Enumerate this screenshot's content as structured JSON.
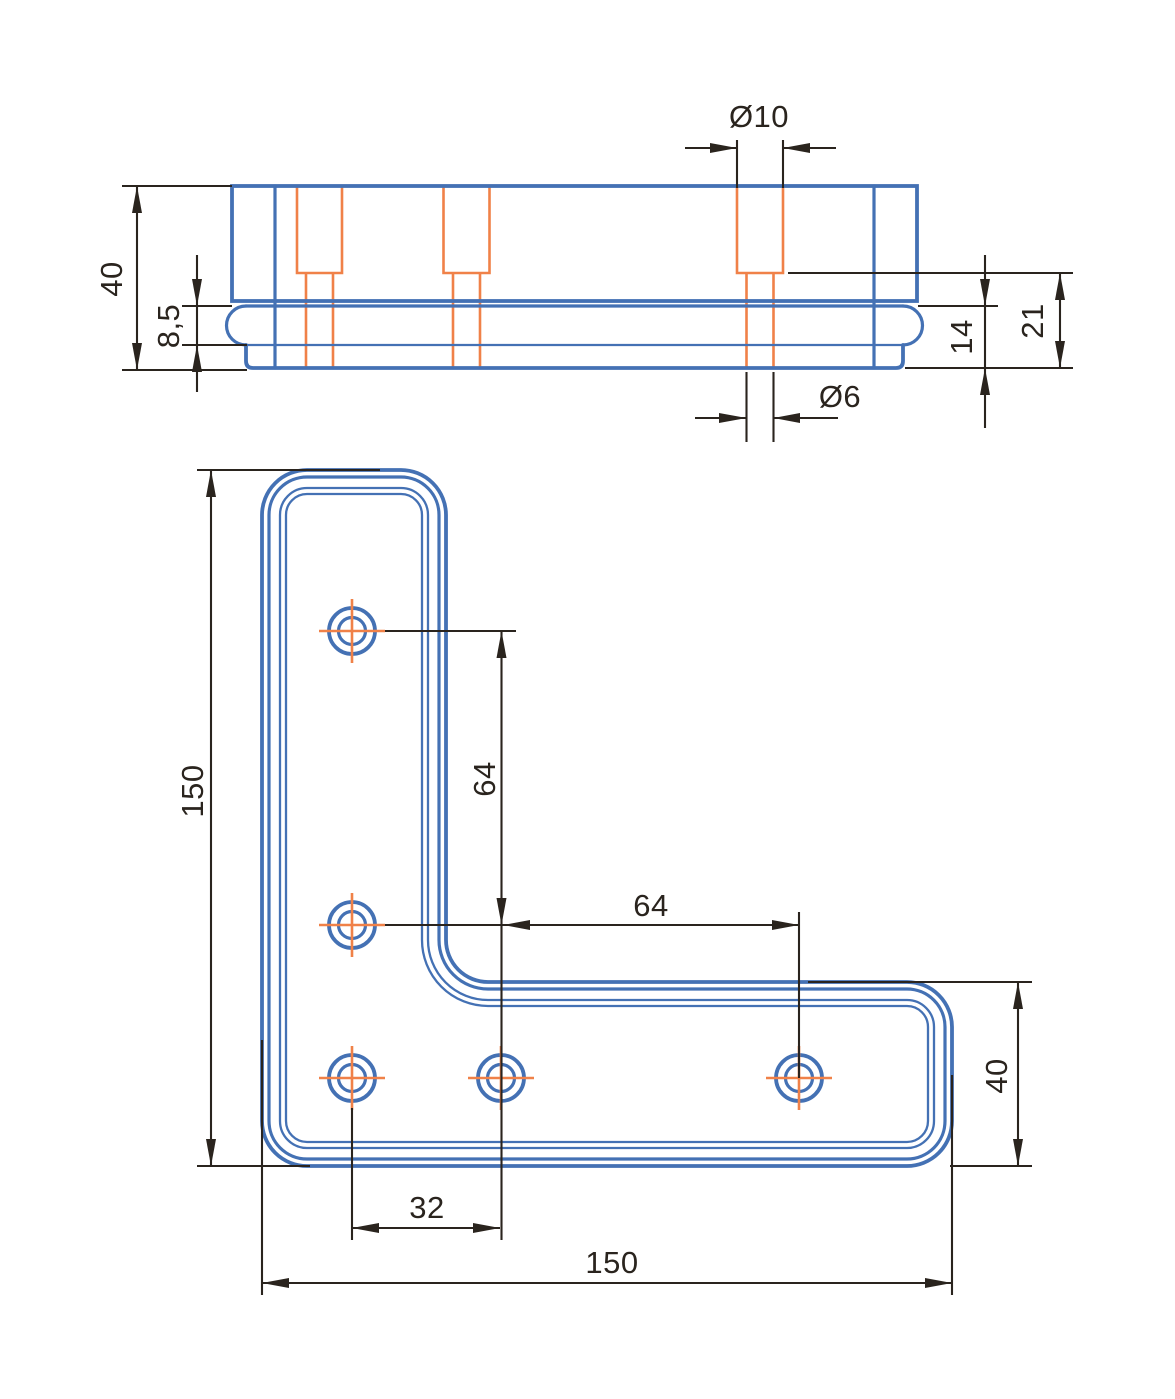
{
  "title": "Two-view technical drawing of an L-shaped corner bracket with counterbored holes",
  "colors": {
    "outline_blue": "#4471b4",
    "hidden_orange": "#f08148",
    "dimension_black": "#2a241e",
    "background": "#ffffff"
  },
  "views": {
    "side_view": {
      "label": "side-elevation-view",
      "dimensions": {
        "counterbore_dia": "Ø10",
        "total_height": "40",
        "lip_height": "8,5",
        "plate_thickness": "14",
        "hole_depth": "21",
        "through_hole_dia": "Ø6"
      }
    },
    "plan_view": {
      "label": "plan-view-L-plate",
      "dimensions": {
        "overall_height": "150",
        "hole_pitch_vertical": "64",
        "hole_pitch_horizontal": "64",
        "leg_width": "40",
        "hole_pitch_small": "32",
        "overall_width": "150"
      }
    }
  }
}
